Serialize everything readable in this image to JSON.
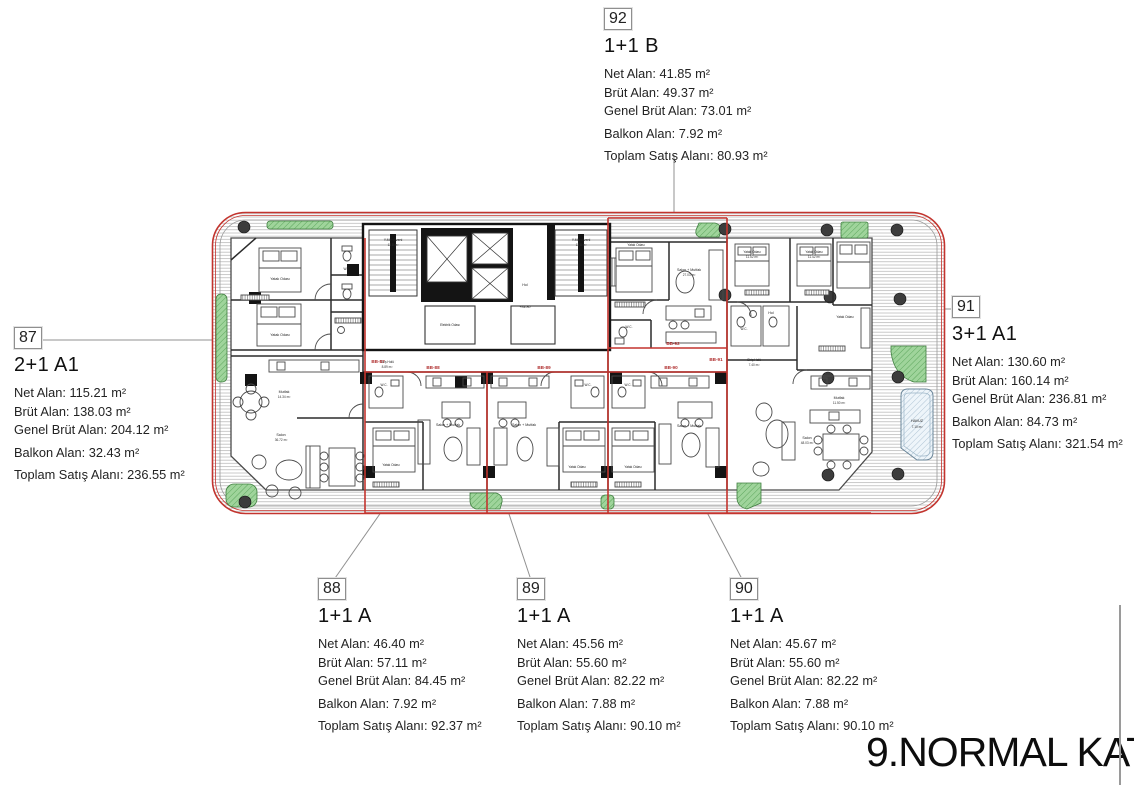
{
  "page_title": "9.NORMAL KAT",
  "units": [
    {
      "tag": "87",
      "type": "2+1 A1",
      "lines": [
        "Net Alan: 115.21 m²",
        "Brüt Alan: 138.03 m²",
        "Genel Brüt Alan: 204.12 m²",
        "Balkon Alan: 32.43 m²",
        "Toplam Satış Alanı: 236.55 m²"
      ]
    },
    {
      "tag": "88",
      "type": "1+1 A",
      "lines": [
        "Net Alan: 46.40 m²",
        "Brüt Alan: 57.11 m²",
        "Genel Brüt Alan: 84.45 m²",
        "Balkon Alan: 7.92 m²",
        "Toplam Satış Alanı: 92.37 m²"
      ]
    },
    {
      "tag": "89",
      "type": "1+1 A",
      "lines": [
        "Net Alan: 45.56 m²",
        "Brüt Alan: 55.60 m²",
        "Genel Brüt Alan: 82.22 m²",
        "Balkon Alan: 7.88 m²",
        "Toplam Satış Alanı: 90.10 m²"
      ]
    },
    {
      "tag": "90",
      "type": "1+1 A",
      "lines": [
        "Net Alan: 45.67 m²",
        "Brüt Alan: 55.60 m²",
        "Genel Brüt Alan: 82.22 m²",
        "Balkon Alan: 7.88 m²",
        "Toplam Satış Alanı: 90.10 m²"
      ]
    },
    {
      "tag": "91",
      "type": "3+1 A1",
      "lines": [
        "Net Alan: 130.60 m²",
        "Brüt Alan: 160.14 m²",
        "Genel Brüt Alan: 236.81 m²",
        "Balkon Alan: 84.73 m²",
        "Toplam Satış Alanı: 321.54 m²"
      ]
    },
    {
      "tag": "92",
      "type": "1+1 B",
      "lines": [
        "Net Alan: 41.85 m²",
        "Brüt Alan: 49.37 m²",
        "Genel Brüt Alan: 73.01 m²",
        "Balkon Alan: 7.92 m²",
        "Toplam Satış Alanı: 80.93 m²"
      ]
    }
  ],
  "plan": {
    "unit_tags": [
      "BB-87",
      "BB-88",
      "BB-89",
      "BB-90",
      "BB-91",
      "BB-92"
    ],
    "rooms": {
      "bedroom": "Yatak Odası",
      "salon_mutfak": "Salon + Mutfak",
      "salon": "Salon",
      "mutfak": "Mutfak",
      "wc": "W.C.",
      "hol": "Hol",
      "giris_holu": "Giriş Holü",
      "stair": "Y.Merdiveni",
      "elektrik": "Elektrik Odası",
      "havuz": "HAVUZ"
    },
    "areas": {
      "havuz": "7.10 m²",
      "salon_87": "36.72 m²",
      "mutfak_87": "14.34 m²",
      "salon_mutfak_92": "27.03 m²",
      "bed1_91": "11.52 m²",
      "bed2_91": "11.42 m²",
      "salon_91": "48.03 m²",
      "mutfak_91": "11.50 m²",
      "stair_area": "13.8 m²",
      "giris_87": "8.89 m²",
      "giris_91": "7.40 m²"
    },
    "level_mark": "+34.80",
    "colors": {
      "boundary_red": "#c3342e",
      "planter_green": "#9fd49b",
      "wall_black": "#141414"
    }
  }
}
